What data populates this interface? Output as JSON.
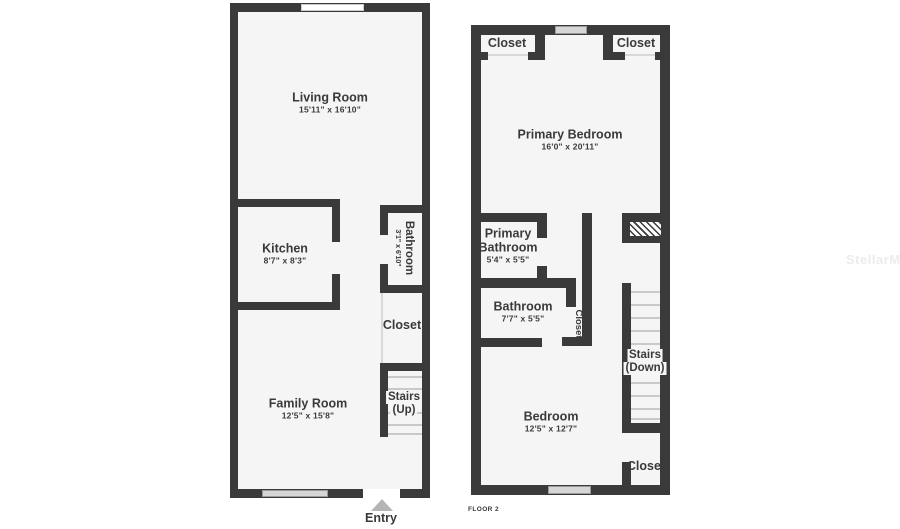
{
  "colors": {
    "wall": "#3a3a3a",
    "room": "#f5f5f5",
    "ink": "#3a3a3a",
    "winfill": "#d6d6d6",
    "arrow": "#b5b5b5",
    "wm": "#ececec"
  },
  "watermark": "StellarMLS",
  "floor1": {
    "entry_label": "Entry",
    "rooms": {
      "living_room": {
        "name": "Living Room",
        "dims": "15'11\" x 16'10\""
      },
      "kitchen": {
        "name": "Kitchen",
        "dims": "8'7\" x 8'3\""
      },
      "bathroom": {
        "name": "Bathroom",
        "dims": "3'1\" x 6'10\""
      },
      "closet": {
        "name": "Closet"
      },
      "stairs": {
        "name": "Stairs",
        "direction": "(Up)"
      },
      "family_room": {
        "name": "Family Room",
        "dims": "12'5\" x 15'8\""
      }
    }
  },
  "floor2": {
    "floor_label": "FLOOR 2",
    "rooms": {
      "closet_top_left": {
        "name": "Closet"
      },
      "closet_top_right": {
        "name": "Closet"
      },
      "primary_bedroom": {
        "name": "Primary Bedroom",
        "dims": "16'0\" x 20'11\""
      },
      "primary_bathroom": {
        "name_line1": "Primary",
        "name_line2": "Bathroom",
        "dims": "5'4\" x 5'5\""
      },
      "bathroom": {
        "name": "Bathroom",
        "dims": "7'7\" x 5'5\""
      },
      "closet_hall": {
        "name": "Closet"
      },
      "stairs": {
        "name": "Stairs",
        "direction": "(Down)"
      },
      "bedroom": {
        "name": "Bedroom",
        "dims": "12'5\" x 12'7\""
      },
      "closet_bottom_right": {
        "name": "Closet"
      }
    }
  }
}
